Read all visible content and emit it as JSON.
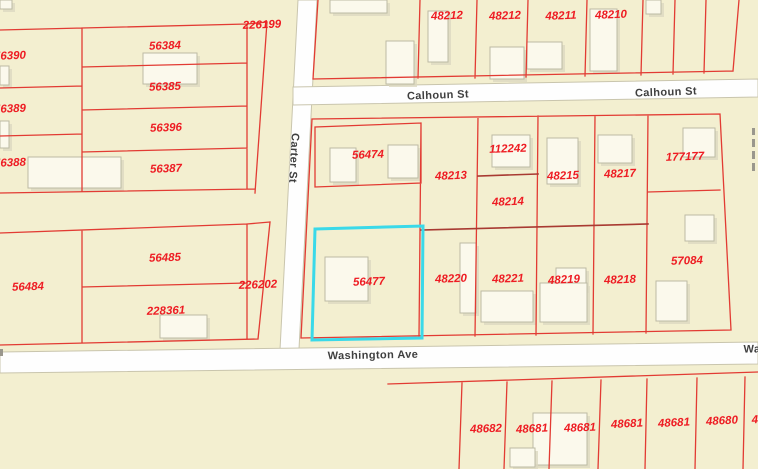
{
  "map_type": "parcel-gis-map",
  "selected_parcel": {
    "id": "56477",
    "highlight_color": "#3ad9e9"
  },
  "theme": {
    "background": "#f3efd0",
    "street_fill": "#fefefe",
    "street_edge": "#c9c5ad",
    "parcel_line": "#e23b33",
    "parcel_line_dark": "#a83a32",
    "parcel_label": "#ee1c23",
    "street_label": "#3f3f3f",
    "building_fill": "#fbf9ec",
    "building_edge": "#bcbaa4",
    "building_shadow": "#dcd8c0",
    "highlight": "#3ad9e9"
  },
  "streets": [
    "Calhoun St",
    "Carter St",
    "Washington Ave"
  ],
  "street_labels": [
    {
      "text": "Calhoun St",
      "x": 438,
      "y": 96,
      "rot": -2
    },
    {
      "text": "Calhoun St",
      "x": 666,
      "y": 93,
      "rot": -2
    },
    {
      "text": "Carter St",
      "x": 293,
      "y": 158,
      "rot": 93
    },
    {
      "text": "Washington Ave",
      "x": 373,
      "y": 356,
      "rot": -1
    },
    {
      "text": "Wa",
      "x": 752,
      "y": 350,
      "rot": -1
    }
  ],
  "parcels": [
    {
      "id": "226199",
      "x": 262,
      "y": 26,
      "rot": -2
    },
    {
      "id": "56390",
      "x": 10,
      "y": 57,
      "rot": -2
    },
    {
      "id": "56384",
      "x": 165,
      "y": 47,
      "rot": -2
    },
    {
      "id": "56385",
      "x": 165,
      "y": 88,
      "rot": -2
    },
    {
      "id": "56389",
      "x": 10,
      "y": 110,
      "rot": -2
    },
    {
      "id": "56396",
      "x": 166,
      "y": 129,
      "rot": -2
    },
    {
      "id": "56388",
      "x": 10,
      "y": 164,
      "rot": -2
    },
    {
      "id": "56387",
      "x": 166,
      "y": 170,
      "rot": -2
    },
    {
      "id": "48212",
      "x": 447,
      "y": 17,
      "rot": -2
    },
    {
      "id": "48212",
      "x": 505,
      "y": 17,
      "rot": -2
    },
    {
      "id": "48211",
      "x": 561,
      "y": 17,
      "rot": -2
    },
    {
      "id": "48210",
      "x": 611,
      "y": 16,
      "rot": -2
    },
    {
      "id": "56474",
      "x": 368,
      "y": 156,
      "rot": -2
    },
    {
      "id": "48213",
      "x": 451,
      "y": 177,
      "rot": -2
    },
    {
      "id": "112242",
      "x": 508,
      "y": 150,
      "rot": -2
    },
    {
      "id": "48214",
      "x": 508,
      "y": 203,
      "rot": -2
    },
    {
      "id": "48215",
      "x": 563,
      "y": 177,
      "rot": -2
    },
    {
      "id": "48217",
      "x": 620,
      "y": 175,
      "rot": -2
    },
    {
      "id": "177177",
      "x": 685,
      "y": 158,
      "rot": -2
    },
    {
      "id": "57084",
      "x": 687,
      "y": 262,
      "rot": -2
    },
    {
      "id": "56485",
      "x": 165,
      "y": 259,
      "rot": -2
    },
    {
      "id": "56484",
      "x": 28,
      "y": 288,
      "rot": -2
    },
    {
      "id": "226202",
      "x": 258,
      "y": 286,
      "rot": -2
    },
    {
      "id": "228361",
      "x": 166,
      "y": 312,
      "rot": -2
    },
    {
      "id": "56477",
      "x": 369,
      "y": 283,
      "rot": -2
    },
    {
      "id": "48220",
      "x": 451,
      "y": 280,
      "rot": -2
    },
    {
      "id": "48221",
      "x": 508,
      "y": 280,
      "rot": -2
    },
    {
      "id": "48219",
      "x": 564,
      "y": 281,
      "rot": -3
    },
    {
      "id": "48218",
      "x": 620,
      "y": 281,
      "rot": -2
    },
    {
      "id": "48682",
      "x": 486,
      "y": 430,
      "rot": -2
    },
    {
      "id": "48681",
      "x": 532,
      "y": 430,
      "rot": -3
    },
    {
      "id": "48681",
      "x": 580,
      "y": 429,
      "rot": -2
    },
    {
      "id": "48681",
      "x": 627,
      "y": 425,
      "rot": -3
    },
    {
      "id": "48681",
      "x": 674,
      "y": 424,
      "rot": -3
    },
    {
      "id": "48680",
      "x": 722,
      "y": 422,
      "rot": -3
    },
    {
      "id": "4",
      "x": 755,
      "y": 421,
      "rot": -3
    }
  ]
}
